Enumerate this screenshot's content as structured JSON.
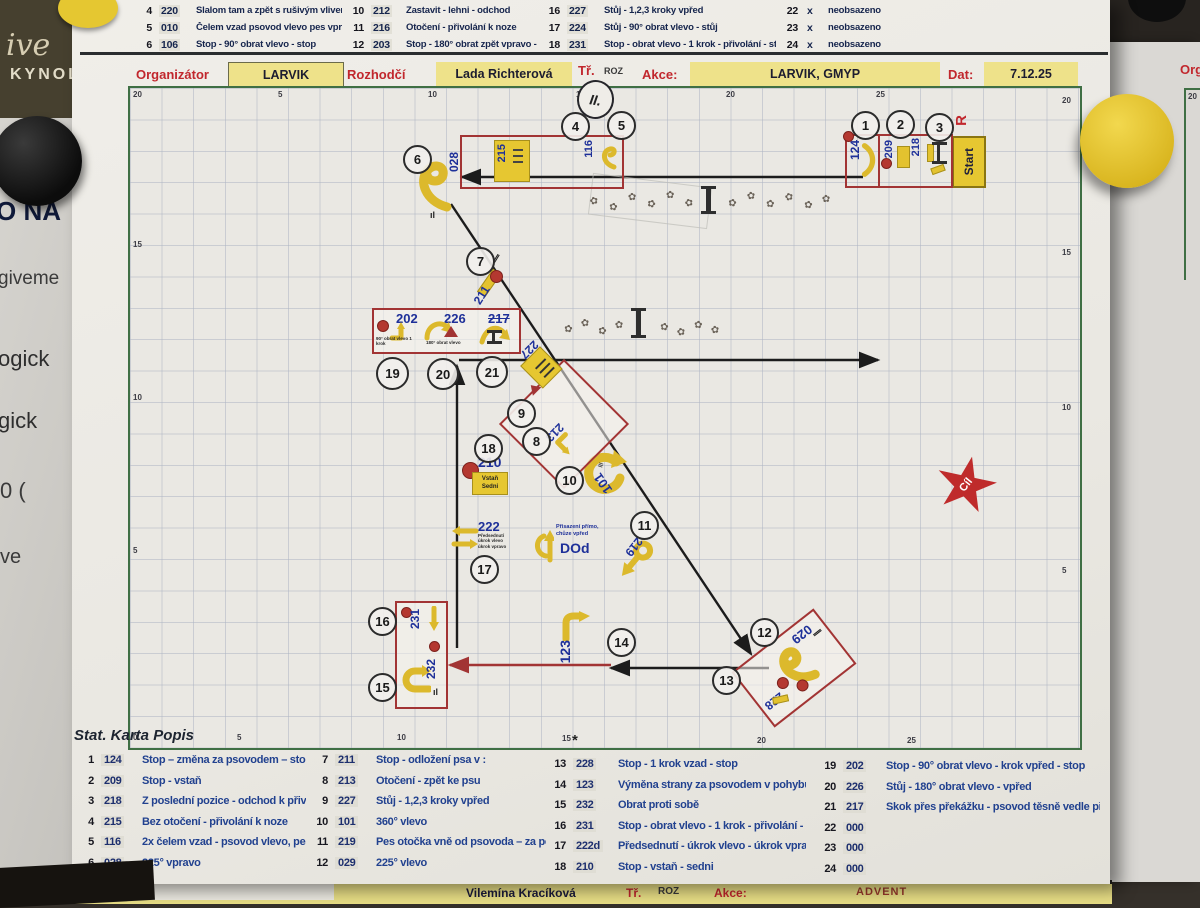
{
  "board": {
    "left_fragments": {
      "logo_script": "ive",
      "logo_kynol": "KYNOL",
      "f1": "O NA",
      "f2": "giveme",
      "f3": "ogick",
      "f4": "gick",
      "f5": "0 (",
      "f6": "ve"
    },
    "right_sheet": {
      "org": "Org",
      "corner": "20"
    }
  },
  "top_table": {
    "g1": [
      {
        "n": "4",
        "code": "220",
        "desc": "Slalom tam a zpět s rušivým vlivem"
      },
      {
        "n": "5",
        "code": "010",
        "desc": "Čelem vzad psovod vlevo pes vprav"
      },
      {
        "n": "6",
        "code": "106",
        "desc": "Stop - 90° obrat vlevo - stop"
      }
    ],
    "g2": [
      {
        "n": "10",
        "code": "212",
        "desc": "Zastavit - lehni - odchod"
      },
      {
        "n": "11",
        "code": "216",
        "desc": "Otočení - přivolání k noze"
      },
      {
        "n": "12",
        "code": "203",
        "desc": "Stop - 180° obrat zpět vpravo - stop"
      }
    ],
    "g3": [
      {
        "n": "16",
        "code": "227",
        "desc": "Stůj - 1,2,3 kroky vpřed"
      },
      {
        "n": "17",
        "code": "224",
        "desc": "Stůj - 90° obrat vlevo - stůj"
      },
      {
        "n": "18",
        "code": "231",
        "desc": "Stop - obrat vlevo - 1 krok - přivolání - stop"
      }
    ],
    "g4": [
      {
        "n": "22",
        "code": "x",
        "desc": "neobsazeno"
      },
      {
        "n": "23",
        "code": "x",
        "desc": "neobsazeno"
      },
      {
        "n": "24",
        "code": "x",
        "desc": "neobsazeno"
      }
    ]
  },
  "header": {
    "organizator_label": "Organizátor",
    "organizator": "LARVIK",
    "rozhodci_label": "Rozhodčí",
    "rozhodci": "Lada Richterová",
    "tr_label": "Tř.",
    "tr_value": "ROZ",
    "class_circle": "II.",
    "akce_label": "Akce:",
    "akce": "LARVIK, GMYP",
    "dat_label": "Dat:",
    "dat": "7.12.25"
  },
  "map": {
    "grid_top": [
      "20",
      "5",
      "10",
      "15",
      "20",
      "25",
      "20"
    ],
    "grid_left": [
      "15",
      "10",
      "5"
    ],
    "grid_right": [
      "15",
      "10",
      "5"
    ],
    "grid_bottom": [
      "0",
      "5",
      "10",
      "15",
      "20",
      "25"
    ],
    "stations": [
      "1",
      "2",
      "3",
      "4",
      "5",
      "6",
      "7",
      "8",
      "9",
      "10",
      "11",
      "12",
      "13",
      "14",
      "15",
      "16",
      "17",
      "18",
      "19",
      "20",
      "21"
    ],
    "signs": {
      "s124": "124",
      "s209": "209",
      "s218": "218",
      "start": "Start",
      "start_r": "R",
      "s215": "215",
      "s116": "116",
      "s028": "028",
      "s211": "211",
      "s202": "202",
      "s226": "226",
      "s217": "217",
      "caption_202": "90° obrat vlevo 1 krok",
      "caption_226": "180° obrat vlevo",
      "s227": "227",
      "s213": "213",
      "s210": "210",
      "s210_l1": "Vstaň",
      "s210_l2": "Sedni",
      "s101": "101",
      "s222": "222",
      "caption_222": "Předsednutí úkrok vlevo úkrok vpravo",
      "dod_caption": "Přisazení přímo, chůze vpřed",
      "dod": "DOd",
      "s219": "219",
      "s123": "123",
      "s231": "231",
      "s232": "232",
      "s029": "029",
      "s228": "228",
      "cil": "Cíl"
    }
  },
  "legend": {
    "title": "Stat. Karta Popis",
    "star": "*",
    "col1": [
      {
        "n": "1",
        "code": "124",
        "desc": "Stop – změna za psovodem – stop"
      },
      {
        "n": "2",
        "code": "209",
        "desc": "Stop - vstaň"
      },
      {
        "n": "3",
        "code": "218",
        "desc": "Z poslední pozice - odchod k přivolá"
      },
      {
        "n": "4",
        "code": "215",
        "desc": "Bez otočení - přivolání k noze"
      },
      {
        "n": "5",
        "code": "116",
        "desc": "2x čelem vzad - psovod vlevo, pes vp"
      },
      {
        "n": "6",
        "code": "028",
        "desc": "225° vpravo"
      }
    ],
    "col2": [
      {
        "n": "7",
        "code": "211",
        "desc": "Stop - odložení psa v :"
      },
      {
        "n": "8",
        "code": "213",
        "desc": "Otočení - zpět ke psu"
      },
      {
        "n": "9",
        "code": "227",
        "desc": "Stůj - 1,2,3 kroky vpřed"
      },
      {
        "n": "10",
        "code": "101",
        "desc": "360° vlevo"
      },
      {
        "n": "11",
        "code": "219",
        "desc": "Pes otočka vně od psovoda – za poh"
      },
      {
        "n": "12",
        "code": "029",
        "desc": "225° vlevo"
      }
    ],
    "col3": [
      {
        "n": "13",
        "code": "228",
        "desc": "Stop - 1 krok vzad - stop"
      },
      {
        "n": "14",
        "code": "123",
        "desc": "Výměna strany za psovodem v pohybu"
      },
      {
        "n": "15",
        "code": "232",
        "desc": "Obrat proti sobě"
      },
      {
        "n": "16",
        "code": "231",
        "desc": "Stop - obrat vlevo - 1 krok - přivolání - stop"
      },
      {
        "n": "17",
        "code": "222d",
        "desc": "Předsednutí - úkrok vlevo - úkrok vpravo - p"
      },
      {
        "n": "18",
        "code": "210",
        "desc": "Stop - vstaň - sedni"
      }
    ],
    "col4": [
      {
        "n": "19",
        "code": "202",
        "desc": "Stop - 90° obrat vlevo - krok vpřed - stop"
      },
      {
        "n": "20",
        "code": "226",
        "desc": "Stůj - 180° obrat vlevo - vpřed"
      },
      {
        "n": "21",
        "code": "217",
        "desc": "Skok přes překážku - psovod těsně vedle př"
      },
      {
        "n": "22",
        "code": "000",
        "desc": ""
      },
      {
        "n": "23",
        "code": "000",
        "desc": ""
      },
      {
        "n": "24",
        "code": "000",
        "desc": ""
      }
    ]
  },
  "bottom_strip": {
    "judge": "Vilemína Kracíková",
    "tr_label": "Tř.",
    "tr_value": "ROZ",
    "akce_label": "Akce:",
    "event": "ADVENT"
  }
}
